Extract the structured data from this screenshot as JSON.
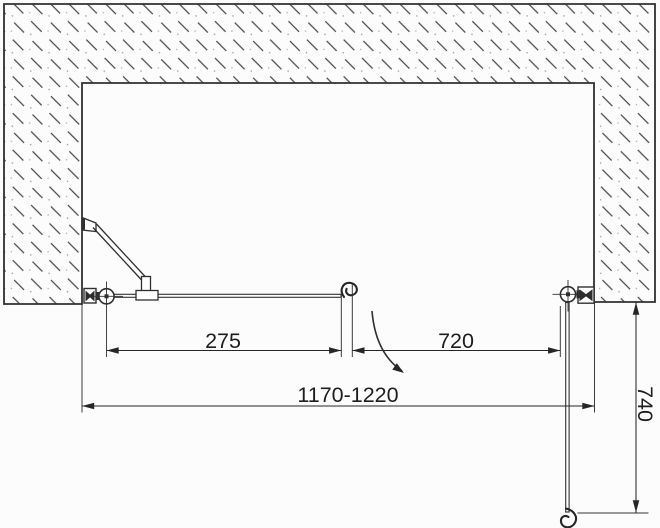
{
  "drawing": {
    "view": "top-view shower niche installation diagram",
    "dimensions": {
      "left_panel_width": "275",
      "door_width": "720",
      "overall_width_range": "1170-1220",
      "door_open_projection": "740"
    },
    "colors": {
      "line": "#303030",
      "hatch": "#4a4a4a",
      "glass": "#3a3a3a",
      "background": "#fcfcfc"
    }
  }
}
